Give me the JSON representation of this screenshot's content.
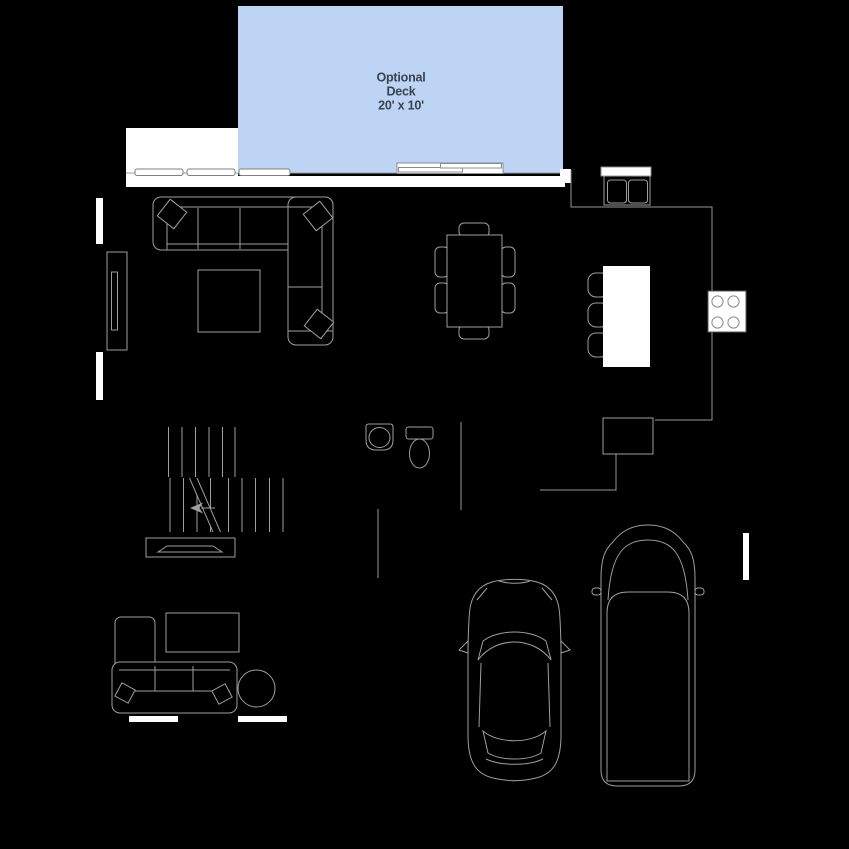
{
  "page": {
    "width": 849,
    "height": 849,
    "background": "#000000"
  },
  "palette": {
    "background": "#000000",
    "line_gray": "#9e9e9e",
    "wall_white": "#ffffff",
    "deck_fill": "#bdd4f4",
    "deck_text": "#3a4350"
  },
  "deck": {
    "label": [
      "Optional",
      "Deck",
      "20' x 10'"
    ],
    "dimensions": "20' x 10'"
  },
  "fixtures": [
    {
      "area": "deck",
      "items": [
        "optional-deck",
        "sliding-door"
      ]
    },
    {
      "area": "great-room",
      "items": [
        "sectional-sofa",
        "throw-pillows",
        "coffee-table",
        "tv-console",
        "window x2"
      ]
    },
    {
      "area": "dining",
      "items": [
        "dining-table",
        "dining-chair x6"
      ]
    },
    {
      "area": "kitchen",
      "items": [
        "double-sink",
        "counter",
        "island",
        "bar-stool x3",
        "cooktop",
        "refrigerator"
      ]
    },
    {
      "area": "stairs",
      "items": [
        "stair-treads",
        "break-line",
        "direction-arrow",
        "bench"
      ]
    },
    {
      "area": "powder-room",
      "items": [
        "vanity-sink",
        "toilet"
      ]
    },
    {
      "area": "flex-room",
      "items": [
        "chaise-lounge",
        "sofa",
        "side-table",
        "round-table",
        "window x2"
      ]
    },
    {
      "area": "garage",
      "items": [
        "sedan-car",
        "suv-car",
        "window"
      ]
    }
  ]
}
